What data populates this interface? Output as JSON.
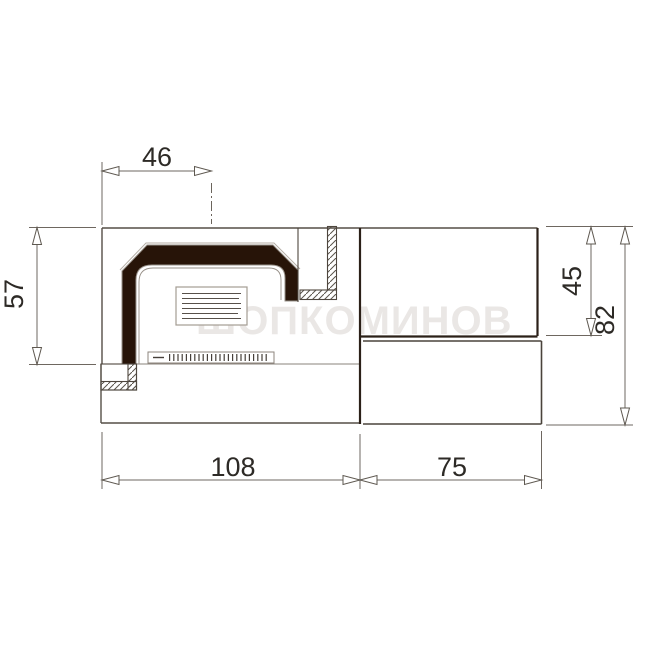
{
  "drawing": {
    "title": "fireplace-insert-section-technical-drawing",
    "watermark": "ШОПКОМИНОВ",
    "colors": {
      "background": "#ffffff",
      "outline": "#554e46",
      "outline_dark": "#2b2018",
      "outline_light": "#978f86",
      "hood_fill": "#271408",
      "dimension_line": "#6e6760",
      "dimension_text": "#2d2a26"
    },
    "dimensions": {
      "top_offset": {
        "value": "46"
      },
      "left_height": {
        "value": "57"
      },
      "right_upper_height": {
        "value": "45"
      },
      "right_total_height": {
        "value": "82"
      },
      "bottom_left_width": {
        "value": "108"
      },
      "bottom_right_width": {
        "value": "75"
      }
    }
  }
}
